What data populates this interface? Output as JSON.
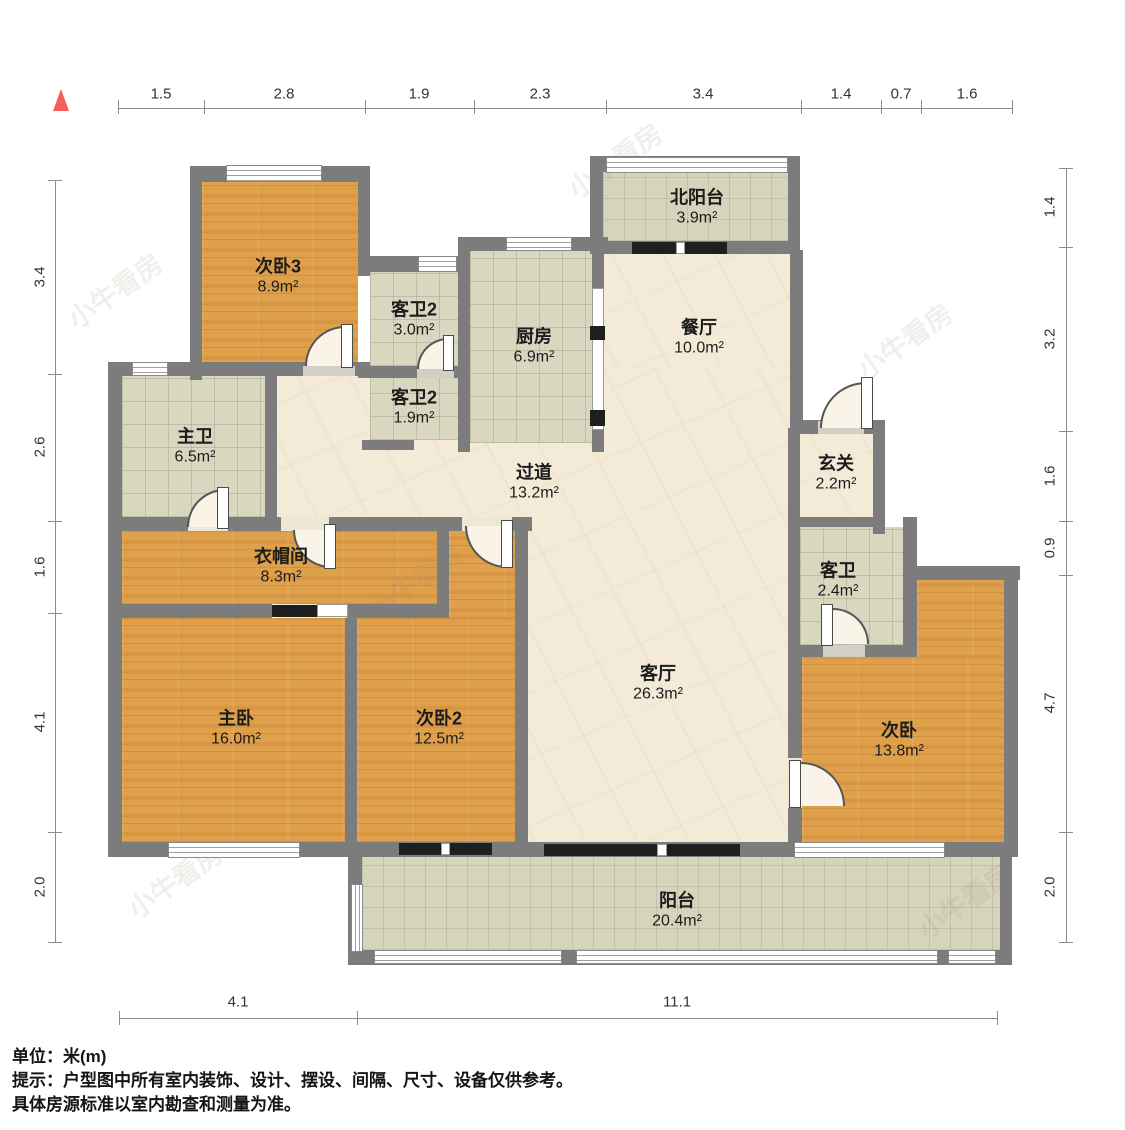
{
  "rooms": [
    {
      "name": "次卧3",
      "area": "8.9m²"
    },
    {
      "name": "客卫2",
      "area": "3.0m²"
    },
    {
      "name": "客卫2",
      "area": "1.9m²"
    },
    {
      "name": "厨房",
      "area": "6.9m²"
    },
    {
      "name": "北阳台",
      "area": "3.9m²"
    },
    {
      "name": "餐厅",
      "area": "10.0m²"
    },
    {
      "name": "主卫",
      "area": "6.5m²"
    },
    {
      "name": "过道",
      "area": "13.2m²"
    },
    {
      "name": "玄关",
      "area": "2.2m²"
    },
    {
      "name": "衣帽间",
      "area": "8.3m²"
    },
    {
      "name": "客卫",
      "area": "2.4m²"
    },
    {
      "name": "主卧",
      "area": "16.0m²"
    },
    {
      "name": "次卧2",
      "area": "12.5m²"
    },
    {
      "name": "客厅",
      "area": "26.3m²"
    },
    {
      "name": "次卧",
      "area": "13.8m²"
    },
    {
      "name": "阳台",
      "area": "20.4m²"
    }
  ],
  "dimensions": {
    "top": [
      "1.5",
      "2.8",
      "1.9",
      "2.3",
      "3.4",
      "1.4",
      "0.7",
      "1.6"
    ],
    "left": [
      "3.4",
      "2.6",
      "1.6",
      "4.1",
      "2.0"
    ],
    "right": [
      "1.4",
      "3.2",
      "1.6",
      "0.9",
      "4.7",
      "2.0"
    ],
    "bottom": [
      "4.1",
      "11.1"
    ]
  },
  "footer": {
    "unit": "单位：米(m)",
    "note1": "提示：户型图中所有室内装饰、设计、摆设、间隔、尺寸、设备仅供参考。",
    "note2": "具体房源标准以室内勘查和测量为准。"
  },
  "watermark": {
    "text": "小牛看房"
  },
  "colors": {
    "wall": "#7c7c7c",
    "wood": "#dfa04c",
    "tile": "#d9d7c0",
    "marble": "#f3ead8",
    "north_arrow": "#f25f5f"
  }
}
